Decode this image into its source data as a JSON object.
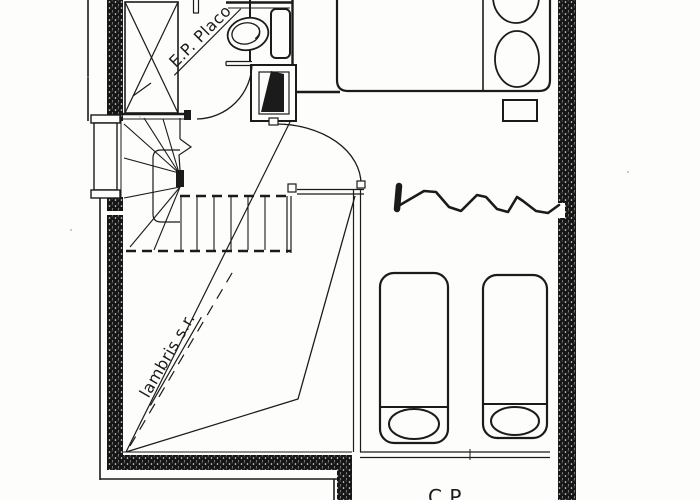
{
  "drawing": {
    "labels": {
      "ep_placo": "E.P. Placo",
      "lambris": "lambris s.r.",
      "cp": "C.P"
    },
    "colors": {
      "ink": "#1b1b1b",
      "paper": "#fdfdfb",
      "wall_fill": "#161616"
    },
    "fixtures": [
      "toilet-icon",
      "shower-tray-icon",
      "double-bed-icon",
      "nightstand-icon",
      "single-bed-icon-left",
      "single-bed-icon-right",
      "winder-staircase",
      "window",
      "wc-door-arc",
      "bedroom-door-arc",
      "zigzag-annotation",
      "cross-braced-duct"
    ]
  }
}
